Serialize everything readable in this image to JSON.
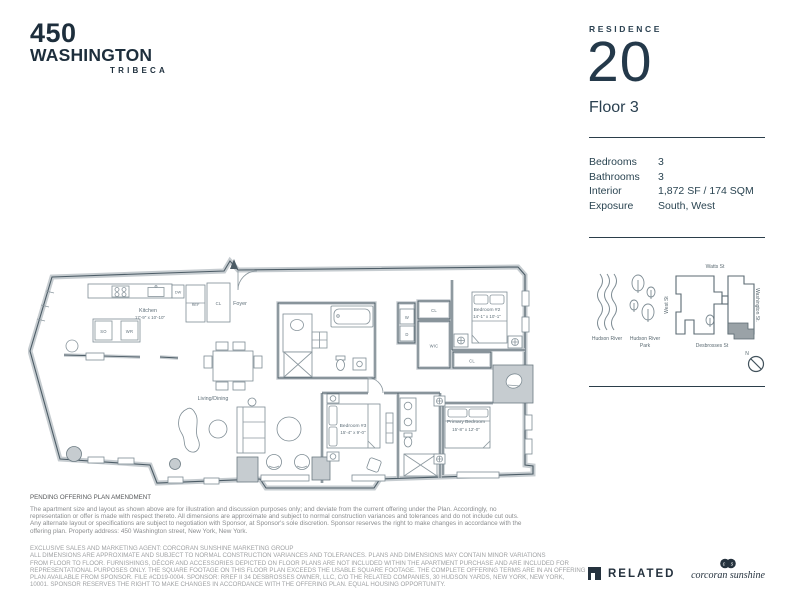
{
  "logo": {
    "number": "450",
    "name": "WASHINGTON",
    "sub": "TRIBECA"
  },
  "residence": {
    "label": "RESIDENCE",
    "number": "20",
    "floor": "Floor 3"
  },
  "details": {
    "rows": [
      {
        "label": "Bedrooms",
        "value": "3"
      },
      {
        "label": "Bathrooms",
        "value": "3"
      },
      {
        "label": "Interior",
        "value": "1,872 SF / 174 SQM"
      },
      {
        "label": "Exposure",
        "value": "South, West"
      }
    ]
  },
  "floorplan": {
    "kitchen_name": "Kitchen",
    "kitchen_dims": "17'-9\" x 10'-10\"",
    "foyer": "Foyer",
    "living": "Living/Dining",
    "bedroom2_name": "Bedroom #2",
    "bedroom2_dims": "14'-1\" x 10'-1\"",
    "bedroom3_name": "Bedroom #3",
    "bedroom3_dims": "15'-4\" x 9'-0\"",
    "primary_name": "Primary Bedroom",
    "primary_dims": "15'-8\" x 12'-0\"",
    "wic": "WIC",
    "cl": "CL",
    "w": "W",
    "d": "D",
    "dw": "DW",
    "ref": "REF",
    "so": "SO",
    "wr": "WR"
  },
  "map": {
    "hudson_river": "Hudson River",
    "park_line1": "Hudson River",
    "park_line2": "Park",
    "watts": "Watts St",
    "west": "West St",
    "washington": "Washington St.",
    "desbrosses": "Desbrosses St",
    "north": "N"
  },
  "legal": {
    "heading": "PENDING OFFERING PLAN AMENDMENT",
    "paragraph_lines": [
      "The apartment size and layout as shown above are for illustration and discussion purposes only; and deviate from the current offering under the Plan. Accordingly, no",
      "representation or offer is made with respect thereto. All dimensions are approximate and subject to normal construction variances and tolerances and do not include cut outs.",
      "Any alternate layout or specifications are subject to negotiation with Sponsor, at Sponsor's sole discretion. Sponsor reserves the right to make changes in accordance with the",
      "offering plan. Property address: 450 Washington street, New York, New York."
    ],
    "disclaimer_lines": [
      "EXCLUSIVE SALES AND MARKETING AGENT: CORCORAN SUNSHINE MARKETING GROUP",
      "ALL DIMENSIONS ARE APPROXIMATE AND SUBJECT TO NORMAL CONSTRUCTION VARIANCES AND TOLERANCES. PLANS AND DIMENSIONS MAY CONTAIN MINOR VARIATIONS",
      "FROM FLOOR TO FLOOR. FURNISHINGS, DÉCOR AND ACCESSORIES DEPICTED ON FLOOR PLANS ARE NOT INCLUDED WITHIN THE APARTMENT PURCHASE AND ARE INCLUDED FOR",
      "REPRESENTATIONAL PURPOSES ONLY. THE SQUARE FOOTAGE ON THIS FLOOR PLAN EXCEEDS THE USABLE SQUARE FOOTAGE. THE COMPLETE OFFERING TERMS ARE IN AN OFFERING",
      "PLAN AVAILABLE FROM SPONSOR. FILE #CD19-0004. SPONSOR: RREF II 34 DESBROSSES OWNER, LLC, C/O THE RELATED COMPANIES, 30 HUDSON YARDS, NEW YORK, NEW YORK,",
      "10001. SPONSOR RESERVES THE RIGHT TO MAKE CHANGES IN ACCORDANCE WITH THE OFFERING PLAN. EQUAL HOUSING OPPORTUNITY."
    ]
  },
  "brands": {
    "related": "RELATED",
    "corcoran": "corcoran sunshine",
    "corcoran_c": "c",
    "corcoran_s": "s"
  },
  "colors": {
    "navy": "#1d2e3c",
    "plan_line": "#4c5c66",
    "wall_fill": "#c6ccd0",
    "unit_fill": "#9aa2a7",
    "legal_gray": "#8b8d8f"
  }
}
